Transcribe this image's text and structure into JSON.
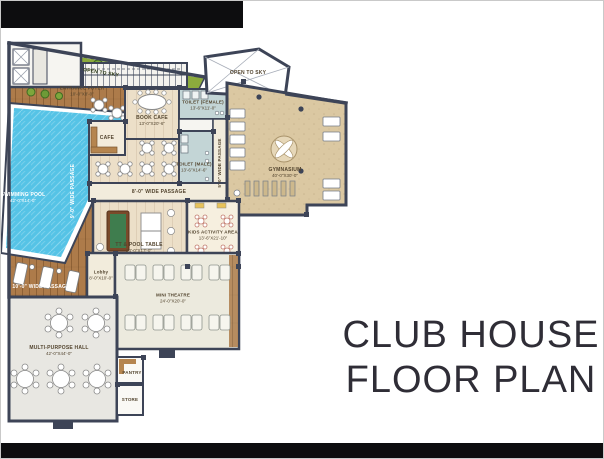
{
  "title": {
    "line1": "CLUB HOUSE",
    "line2": "FLOOR PLAN"
  },
  "open_areas": {
    "open_to_sky_garden": "OPEN TO SKY",
    "open_to_sky_court": "OPEN TO SKY"
  },
  "rooms": {
    "swimming_pool": {
      "name": "SWIMMING POOL",
      "dims": "42'-0\"X14'-0\""
    },
    "entrance_foyer": {
      "name": "ENTRANCE FOYER",
      "dims": "10'-0\"X8'-0\""
    },
    "book_cafe": {
      "name": "BOOK CAFE",
      "dims": "13'-0\"X20'-6\""
    },
    "cafe": {
      "name": "CAFE"
    },
    "toilet_female": {
      "name": "TOILET (FEMALE)",
      "dims": "13'-6\"X11'-0\""
    },
    "toilet_male": {
      "name": "TOILET (MALE)",
      "dims": "13'-6\"X14'-6\""
    },
    "gymnasium": {
      "name": "GYMNASIUM",
      "dims": "40'-0\"X30'-0\""
    },
    "tt_pool_table": {
      "name": "TT & POOL TABLE",
      "dims": "24'-0\"X17'-0\""
    },
    "kids_activity": {
      "name": "KIDS ACTIVITY AREA",
      "dims": "13'-6\"X21'-10\""
    },
    "lobby": {
      "name": "Lobby",
      "dims": "8'-0\"X10'-0\""
    },
    "mini_theatre": {
      "name": "MINI THEATRE",
      "dims": "24'-0\"X20'-0\""
    },
    "multi_purpose_hall": {
      "name": "MULTI-PURPOSE HALL",
      "dims": "42'-0\"X44'-0\""
    },
    "pantry": {
      "name": "PANTRY"
    },
    "store": {
      "name": "STORE"
    }
  },
  "passages": {
    "p5": "5'-0\" WIDE PASSAGE",
    "p8": "8'-0\" WIDE PASSAGE",
    "p9": "9'-0\" WIDE PASSAGE",
    "p10": "10'-0\" WIDE PASSAGE"
  },
  "colors": {
    "wall": "#3d4457",
    "pool_water": "#55c3e6",
    "deck_wood": "#ad7b4a",
    "landscape_green": "#8cab3d",
    "gym_floor": "#dbc8a2",
    "light_floor": "#ecdfc8",
    "toilet_floor": "#c3d5d6",
    "banner_black": "#0d0d0f",
    "title_text": "#2f2d36"
  }
}
